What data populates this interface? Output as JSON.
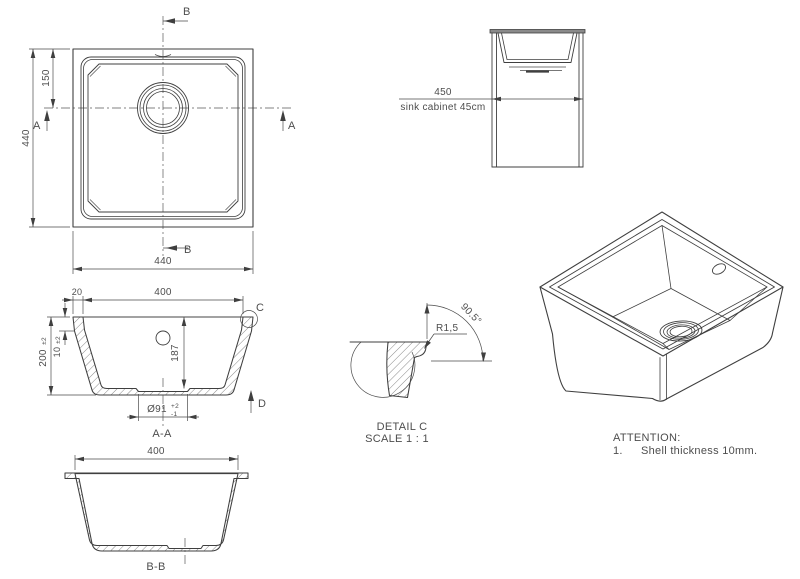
{
  "drawing_title": "Undermount sink technical drawing",
  "colors": {
    "line": "#3f3f3f",
    "text": "#4d4d4d",
    "background": "#ffffff"
  },
  "plan": {
    "b_top": "B",
    "b_bottom": "B",
    "a_left": "A",
    "a_right": "A",
    "dim_overall_height": "440",
    "dim_drain_offset": "150",
    "dim_overall_width": "440"
  },
  "cabinet": {
    "dim_width": "450",
    "label": "sink cabinet 45cm"
  },
  "aa": {
    "dim_flange": "20",
    "dim_inner_width": "400",
    "dim_rim_height": "10",
    "dim_rim_tol": "±2",
    "dim_height": "200",
    "dim_height_tol": "±2",
    "dim_depth": "187",
    "dim_drain": "Ø91",
    "dim_drain_tol_plus": "+2",
    "dim_drain_tol_minus": "-1",
    "detail_label": "C",
    "direction_label": "D",
    "title": "A-A"
  },
  "bb": {
    "dim_inner_width": "400",
    "title": "B-B"
  },
  "detail_c": {
    "radius": "R1,5",
    "angle": "90.5°",
    "title": "DETAIL C",
    "scale": "SCALE 1 : 1"
  },
  "notes": {
    "heading": "ATTENTION:",
    "item_number": "1.",
    "item_text": "Shell thickness 10mm."
  }
}
